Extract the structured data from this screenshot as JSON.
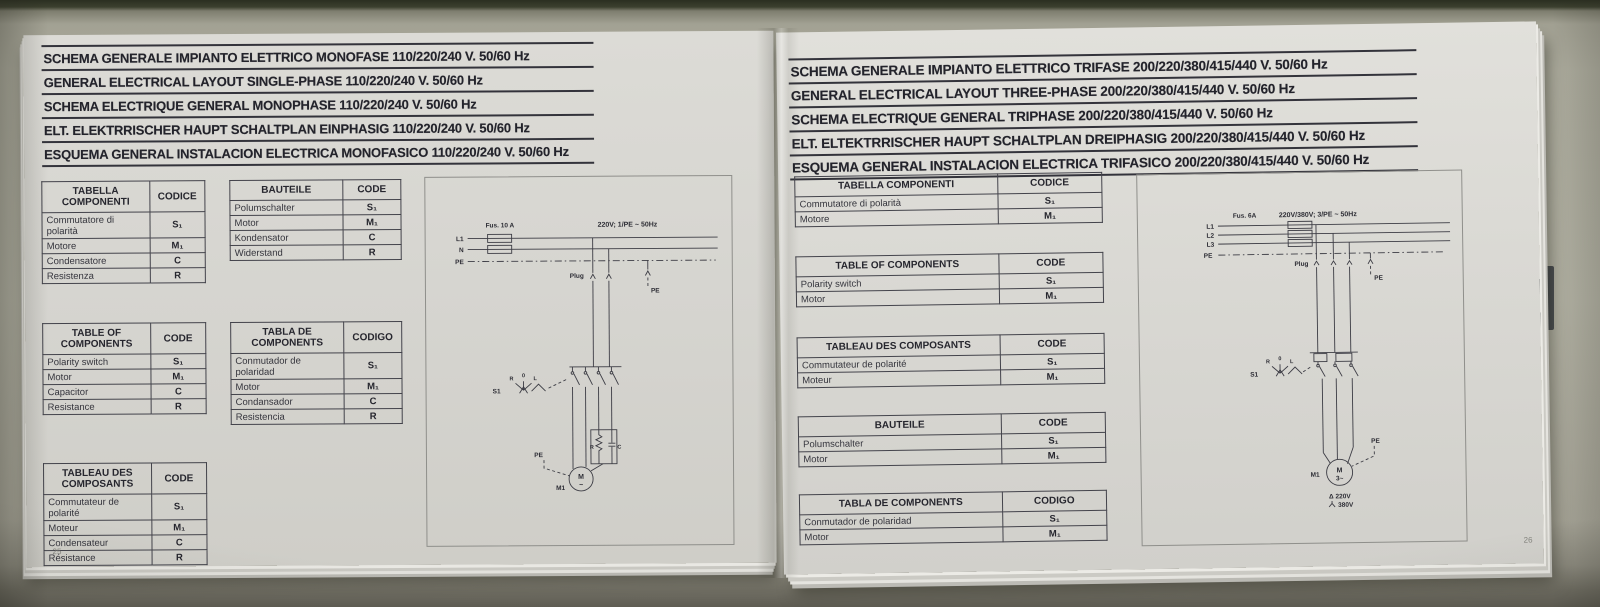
{
  "left": {
    "page_number": "25",
    "titles": [
      "SCHEMA GENERALE IMPIANTO ELETTRICO MONOFASE 110/220/240 V. 50/60 Hz",
      "GENERAL ELECTRICAL LAYOUT SINGLE-PHASE 110/220/240 V. 50/60 Hz",
      "SCHEMA ELECTRIQUE GENERAL MONOPHASE 110/220/240 V. 50/60 Hz",
      "ELT. ELEKTRRISCHER HAUPT SCHALTPLAN EINPHASIG 110/220/240 V. 50/60 Hz",
      "ESQUEMA GENERAL INSTALACION ELECTRICA MONOFASICO 110/220/240 V. 50/60 Hz"
    ],
    "tables": [
      {
        "header": [
          "TABELLA COMPONENTI",
          "CODICE"
        ],
        "rows": [
          [
            "Commutatore di polarità",
            "S₁"
          ],
          [
            "Motore",
            "M₁"
          ],
          [
            "Condensatore",
            "C"
          ],
          [
            "Resistenza",
            "R"
          ]
        ]
      },
      {
        "header": [
          "BAUTEILE",
          "CODE"
        ],
        "rows": [
          [
            "Polumschalter",
            "S₁"
          ],
          [
            "Motor",
            "M₁"
          ],
          [
            "Kondensator",
            "C"
          ],
          [
            "Widerstand",
            "R"
          ]
        ]
      },
      {
        "header": [
          "TABLE OF COMPONENTS",
          "CODE"
        ],
        "rows": [
          [
            "Polarity switch",
            "S₁"
          ],
          [
            "Motor",
            "M₁"
          ],
          [
            "Capacitor",
            "C"
          ],
          [
            "Resistance",
            "R"
          ]
        ]
      },
      {
        "header": [
          "TABLA DE COMPONENTS",
          "CODIGO"
        ],
        "rows": [
          [
            "Conmutador de polaridad",
            "S₁"
          ],
          [
            "Motor",
            "M₁"
          ],
          [
            "Condansador",
            "C"
          ],
          [
            "Resistencia",
            "R"
          ]
        ]
      },
      {
        "header": [
          "TABLEAU DES COMPOSANTS",
          "CODE"
        ],
        "rows": [
          [
            "Commutateur de polarité",
            "S₁"
          ],
          [
            "Moteur",
            "M₁"
          ],
          [
            "Condensateur",
            "C"
          ],
          [
            "Résistance",
            "R"
          ]
        ]
      }
    ],
    "diagram": {
      "fuse": "Fus. 10 A",
      "supply": "220V; 1/PE ~ 50Hz",
      "l1": "L1",
      "n": "N",
      "pe": "PE",
      "plug": "Plug",
      "pe_drop": "PE",
      "s1": "S1",
      "pos_r": "R",
      "pos_0": "0",
      "pos_l": "L",
      "r": "R",
      "c": "C",
      "pe_motor": "PE",
      "motor": "M",
      "phase": "~",
      "motor_code": "M1"
    }
  },
  "right": {
    "page_number": "26",
    "titles": [
      "SCHEMA GENERALE IMPIANTO ELETTRICO TRIFASE 200/220/380/415/440 V. 50/60 Hz",
      "GENERAL ELECTRICAL LAYOUT THREE-PHASE 200/220/380/415/440 V. 50/60 Hz",
      "SCHEMA ELECTRIQUE GENERAL TRIPHASE 200/220/380/415/440 V. 50/60 Hz",
      "ELT. ELTEKTRRISCHER HAUPT SCHALTPLAN DREIPHASIG 200/220/380/415/440 V. 50/60 Hz",
      "ESQUEMA GENERAL INSTALACION ELECTRICA TRIFASICO 200/220/380/415/440 V. 50/60 Hz"
    ],
    "tables": [
      {
        "header": [
          "TABELLA COMPONENTI",
          "CODICE"
        ],
        "rows": [
          [
            "Commutatore di polarità",
            "S₁"
          ],
          [
            "Motore",
            "M₁"
          ]
        ]
      },
      {
        "header": [
          "TABLE OF COMPONENTS",
          "CODE"
        ],
        "rows": [
          [
            "Polarity switch",
            "S₁"
          ],
          [
            "Motor",
            "M₁"
          ]
        ]
      },
      {
        "header": [
          "TABLEAU DES COMPOSANTS",
          "CODE"
        ],
        "rows": [
          [
            "Commutateur de polarité",
            "S₁"
          ],
          [
            "Moteur",
            "M₁"
          ]
        ]
      },
      {
        "header": [
          "BAUTEILE",
          "CODE"
        ],
        "rows": [
          [
            "Polumschalter",
            "S₁"
          ],
          [
            "Motor",
            "M₁"
          ]
        ]
      },
      {
        "header": [
          "TABLA DE COMPONENTS",
          "CODIGO"
        ],
        "rows": [
          [
            "Conmutador de polaridad",
            "S₁"
          ],
          [
            "Motor",
            "M₁"
          ]
        ]
      }
    ],
    "diagram": {
      "fuse": "Fus. 6A",
      "supply": "220V/380V; 3/PE ~ 50Hz",
      "l1": "L1",
      "l2": "L2",
      "l3": "L3",
      "pe": "PE",
      "plug": "Plug",
      "pe_drop": "PE",
      "s1": "S1",
      "pos_r": "R",
      "pos_0": "0",
      "pos_l": "L",
      "pe_motor": "PE",
      "motor": "M",
      "phase": "3~",
      "motor_code": "M1",
      "delta": "Δ 220V",
      "star": "380V"
    }
  }
}
